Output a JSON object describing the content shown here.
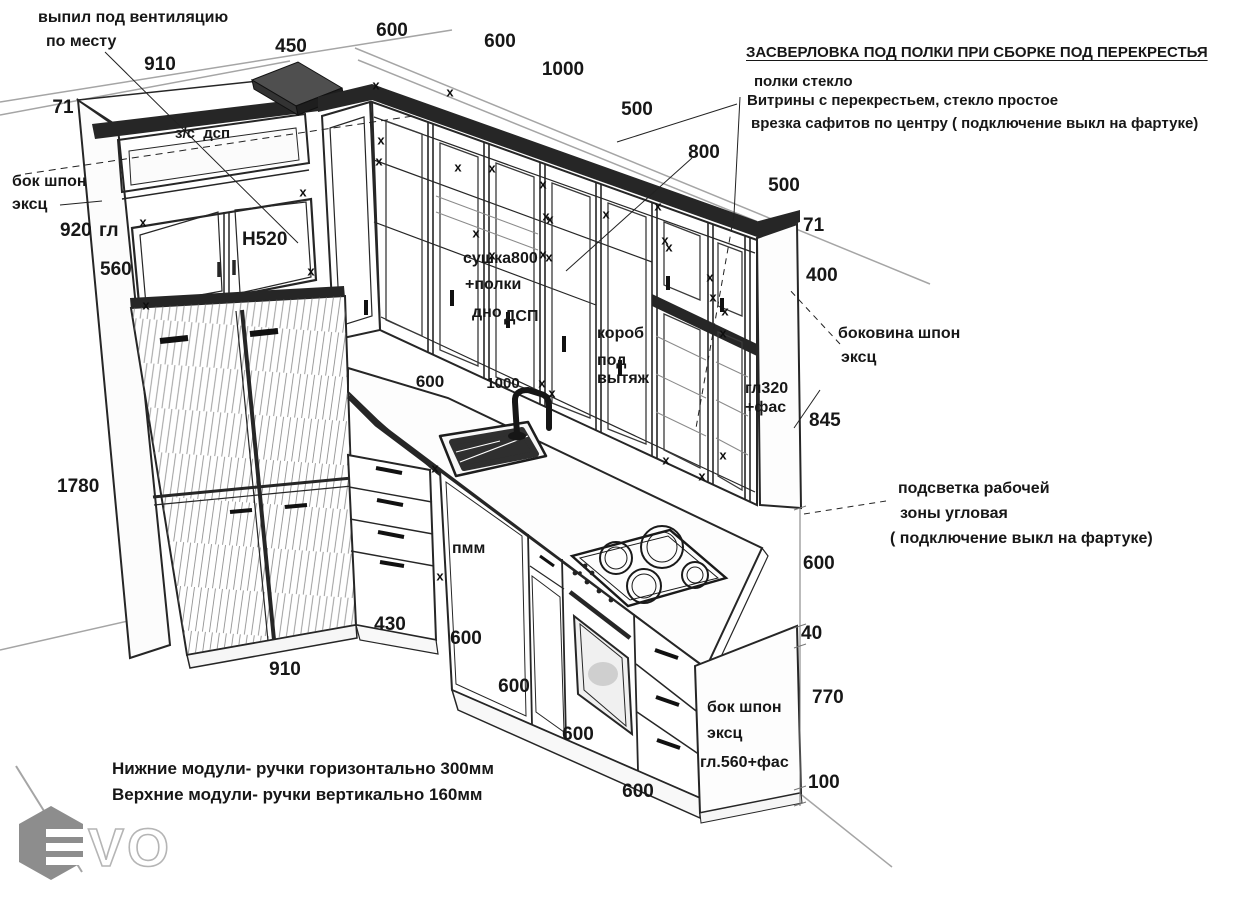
{
  "colors": {
    "ink": "#262626",
    "guide": "#a5a5a5",
    "dark_fill": "#262626",
    "logo_gray": "#8d8d8d",
    "background": "#ffffff"
  },
  "watermark": {
    "letters": "VO"
  },
  "labels": [
    {
      "n": "note-vent-line1",
      "t": "выпил под вентиляцию",
      "x": 38,
      "y": 10,
      "s": 16,
      "a": "l"
    },
    {
      "n": "note-vent-line2",
      "t": "по месту",
      "x": 46,
      "y": 34,
      "s": 16,
      "a": "l"
    },
    {
      "n": "dim-top-910",
      "t": "910",
      "x": 160,
      "y": 55,
      "s": 19,
      "a": "c"
    },
    {
      "n": "dim-top-450",
      "t": "450",
      "x": 291,
      "y": 37,
      "s": 19,
      "a": "c"
    },
    {
      "n": "dim-top-600a",
      "t": "600",
      "x": 392,
      "y": 21,
      "s": 19,
      "a": "c"
    },
    {
      "n": "dim-top-600b",
      "t": "600",
      "x": 500,
      "y": 32,
      "s": 19,
      "a": "c"
    },
    {
      "n": "dim-top-1000",
      "t": "1000",
      "x": 563,
      "y": 60,
      "s": 19,
      "a": "c"
    },
    {
      "n": "dim-top-500a",
      "t": "500",
      "x": 637,
      "y": 100,
      "s": 19,
      "a": "c"
    },
    {
      "n": "dim-top-800",
      "t": "800",
      "x": 704,
      "y": 143,
      "s": 19,
      "a": "c"
    },
    {
      "n": "dim-top-500b",
      "t": "500",
      "x": 784,
      "y": 176,
      "s": 19,
      "a": "c"
    },
    {
      "n": "dim-left-71",
      "t": "71",
      "x": 63,
      "y": 98,
      "s": 19,
      "a": "c"
    },
    {
      "n": "label-zs-dsp",
      "t": "з/с  дсп",
      "x": 175,
      "y": 126,
      "s": 15,
      "a": "l"
    },
    {
      "n": "note-left-bok-1",
      "t": "бок шпон",
      "x": 12,
      "y": 174,
      "s": 16,
      "a": "l"
    },
    {
      "n": "note-left-bok-2",
      "t": "эксц",
      "x": 12,
      "y": 197,
      "s": 16,
      "a": "l"
    },
    {
      "n": "dim-920",
      "t": "920",
      "x": 60,
      "y": 221,
      "s": 19,
      "a": "l"
    },
    {
      "n": "label-gl",
      "t": "гл",
      "x": 99,
      "y": 221,
      "s": 19,
      "a": "l"
    },
    {
      "n": "dim-560",
      "t": "560",
      "x": 100,
      "y": 260,
      "s": 19,
      "a": "l"
    },
    {
      "n": "label-h520",
      "t": "H520",
      "x": 242,
      "y": 230,
      "s": 19,
      "a": "l"
    },
    {
      "n": "label-sushka-1",
      "t": "сушка800",
      "x": 463,
      "y": 251,
      "s": 16,
      "a": "l"
    },
    {
      "n": "label-sushka-2",
      "t": "+полки",
      "x": 465,
      "y": 277,
      "s": 16,
      "a": "l"
    },
    {
      "n": "label-sushka-3",
      "t": "дно",
      "x": 472,
      "y": 305,
      "s": 16,
      "a": "l"
    },
    {
      "n": "label-sushka-4",
      "t": "ДСП",
      "x": 504,
      "y": 309,
      "s": 16,
      "a": "l"
    },
    {
      "n": "label-korob-1",
      "t": "короб",
      "x": 597,
      "y": 326,
      "s": 16,
      "a": "l"
    },
    {
      "n": "label-korob-2",
      "t": "под",
      "x": 597,
      "y": 353,
      "s": 16,
      "a": "l"
    },
    {
      "n": "label-korob-3",
      "t": "вытяж",
      "x": 597,
      "y": 371,
      "s": 16,
      "a": "l"
    },
    {
      "n": "label-gl320-1",
      "t": "гл320",
      "x": 745,
      "y": 381,
      "s": 16,
      "a": "l"
    },
    {
      "n": "label-gl320-2",
      "t": "+фас",
      "x": 745,
      "y": 400,
      "s": 16,
      "a": "l"
    },
    {
      "n": "dim-right-71",
      "t": "71",
      "x": 803,
      "y": 216,
      "s": 19,
      "a": "l"
    },
    {
      "n": "dim-right-400",
      "t": "400",
      "x": 806,
      "y": 266,
      "s": 19,
      "a": "l"
    },
    {
      "n": "note-bokovina-1",
      "t": "боковина шпон",
      "x": 838,
      "y": 326,
      "s": 16,
      "a": "l"
    },
    {
      "n": "note-bokovina-2",
      "t": "эксц",
      "x": 841,
      "y": 350,
      "s": 16,
      "a": "l"
    },
    {
      "n": "dim-right-845",
      "t": "845",
      "x": 809,
      "y": 411,
      "s": 19,
      "a": "l"
    },
    {
      "n": "dim-sink-600",
      "t": "600",
      "x": 430,
      "y": 373,
      "s": 17,
      "a": "c"
    },
    {
      "n": "dim-sink-1000",
      "t": "1000",
      "x": 503,
      "y": 376,
      "s": 15,
      "a": "c"
    },
    {
      "n": "note-light-1",
      "t": "подсветка рабочей",
      "x": 898,
      "y": 481,
      "s": 16,
      "a": "l"
    },
    {
      "n": "note-light-2",
      "t": "зоны угловая",
      "x": 900,
      "y": 506,
      "s": 16,
      "a": "l"
    },
    {
      "n": "note-light-3",
      "t": "( подключение выкл на фартуке)",
      "x": 890,
      "y": 531,
      "s": 16,
      "a": "l"
    },
    {
      "n": "dim-right-600",
      "t": "600",
      "x": 803,
      "y": 554,
      "s": 19,
      "a": "l"
    },
    {
      "n": "dim-1780",
      "t": "1780",
      "x": 57,
      "y": 477,
      "s": 19,
      "a": "l"
    },
    {
      "n": "dim-430",
      "t": "430",
      "x": 390,
      "y": 615,
      "s": 19,
      "a": "c"
    },
    {
      "n": "dim-bottom-910",
      "t": "910",
      "x": 285,
      "y": 660,
      "s": 19,
      "a": "c"
    },
    {
      "n": "dim-base-600a",
      "t": "600",
      "x": 466,
      "y": 629,
      "s": 19,
      "a": "c"
    },
    {
      "n": "dim-base-600b",
      "t": "600",
      "x": 514,
      "y": 677,
      "s": 19,
      "a": "c"
    },
    {
      "n": "dim-base-600c",
      "t": "600",
      "x": 578,
      "y": 725,
      "s": 19,
      "a": "c"
    },
    {
      "n": "dim-base-600d",
      "t": "600",
      "x": 638,
      "y": 782,
      "s": 19,
      "a": "c"
    },
    {
      "n": "dim-right-40",
      "t": "40",
      "x": 801,
      "y": 624,
      "s": 19,
      "a": "l"
    },
    {
      "n": "dim-right-770",
      "t": "770",
      "x": 812,
      "y": 688,
      "s": 19,
      "a": "l"
    },
    {
      "n": "dim-right-100",
      "t": "100",
      "x": 808,
      "y": 773,
      "s": 19,
      "a": "l"
    },
    {
      "n": "note-base-bok-1",
      "t": "бок шпон",
      "x": 707,
      "y": 700,
      "s": 16,
      "a": "l"
    },
    {
      "n": "note-base-bok-2",
      "t": "эксц",
      "x": 707,
      "y": 726,
      "s": 16,
      "a": "l"
    },
    {
      "n": "label-gl560",
      "t": "гл.560+фас",
      "x": 700,
      "y": 755,
      "s": 16,
      "a": "l"
    },
    {
      "n": "label-pmm",
      "t": "пмм",
      "x": 452,
      "y": 541,
      "s": 16,
      "a": "l"
    },
    {
      "n": "heading-drilling",
      "t": "ЗАСВЕРЛОВКА ПОД ПОЛКИ ПРИ СБОРКЕ ПОД ПЕРЕКРЕСТЬЯ",
      "x": 746,
      "y": 45,
      "s": 15,
      "a": "l",
      "u": true
    },
    {
      "n": "anno-polki-steklo",
      "t": "полки стекло",
      "x": 754,
      "y": 74,
      "s": 15,
      "a": "l"
    },
    {
      "n": "anno-vitriny",
      "t": "Витрины с перекрестьем, стекло простое",
      "x": 747,
      "y": 93,
      "s": 15,
      "a": "l"
    },
    {
      "n": "anno-vrezka",
      "t": "врезка сафитов по центру ( подключение выкл на фартуке)",
      "x": 751,
      "y": 116,
      "s": 15,
      "a": "l"
    },
    {
      "n": "note-handles-bottom",
      "t": "Нижние модули- ручки горизонтально 300мм",
      "x": 112,
      "y": 760,
      "s": 17,
      "a": "l"
    },
    {
      "n": "note-handles-top",
      "t": "Верхние модули- ручки вертикально 160мм",
      "x": 112,
      "y": 786,
      "s": 17,
      "a": "l"
    }
  ],
  "x_marks": [
    [
      143,
      222
    ],
    [
      303,
      192
    ],
    [
      311,
      271
    ],
    [
      146,
      305
    ],
    [
      376,
      85
    ],
    [
      450,
      92
    ],
    [
      381,
      140
    ],
    [
      379,
      161
    ],
    [
      458,
      167
    ],
    [
      492,
      168
    ],
    [
      476,
      233
    ],
    [
      492,
      255
    ],
    [
      543,
      184
    ],
    [
      546,
      216
    ],
    [
      550,
      219
    ],
    [
      543,
      254
    ],
    [
      549,
      257
    ],
    [
      606,
      214
    ],
    [
      658,
      206
    ],
    [
      665,
      240
    ],
    [
      669,
      247
    ],
    [
      710,
      277
    ],
    [
      713,
      297
    ],
    [
      725,
      311
    ],
    [
      723,
      333
    ],
    [
      666,
      460
    ],
    [
      702,
      476
    ],
    [
      723,
      455
    ],
    [
      542,
      383
    ],
    [
      552,
      393
    ],
    [
      435,
      468
    ],
    [
      440,
      576
    ]
  ]
}
